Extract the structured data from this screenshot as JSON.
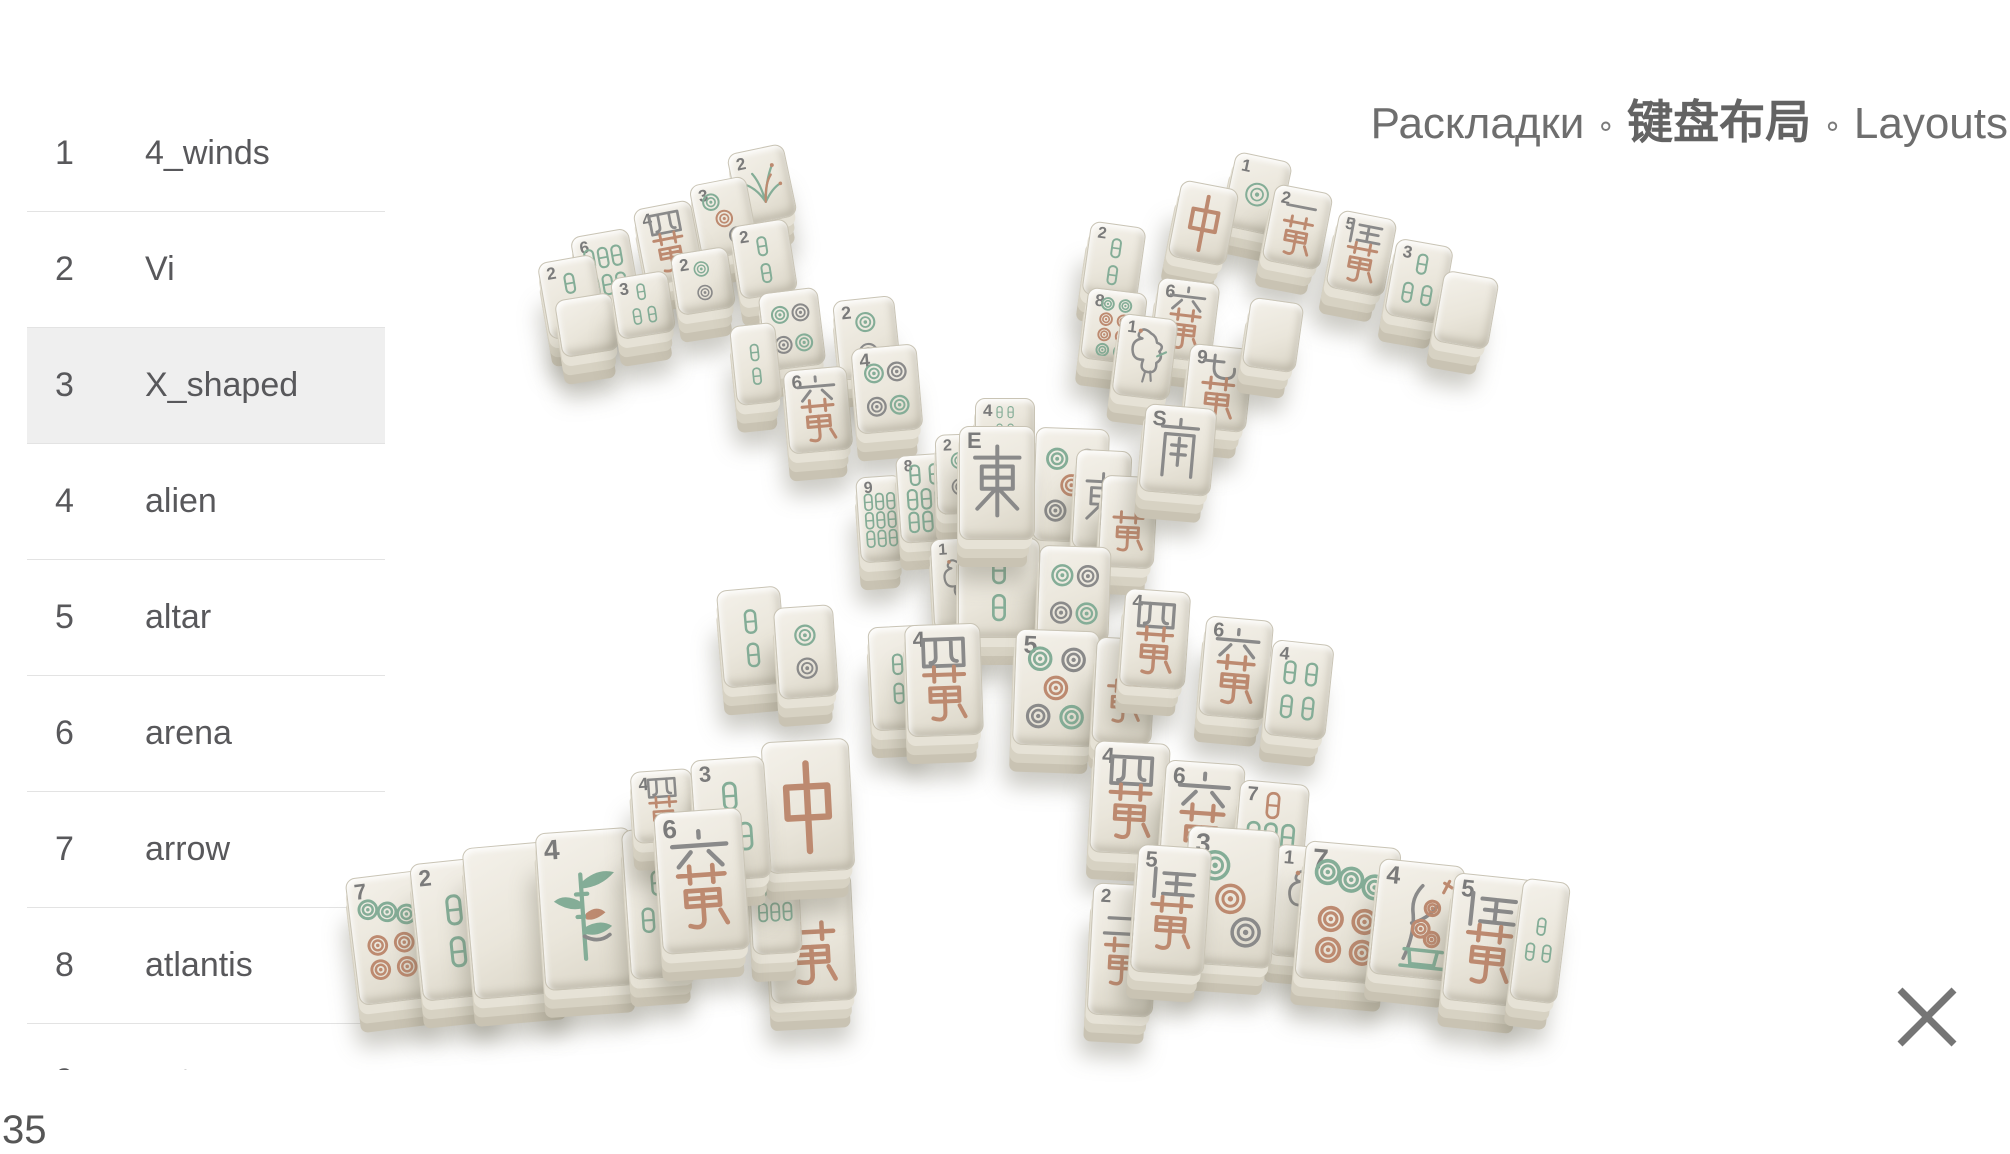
{
  "header": {
    "title_ru": "Раскладки",
    "title_zh": "键盘布局",
    "title_en": "Layouts",
    "separator": "∘"
  },
  "sidebar": {
    "selected_index": 2,
    "items": [
      {
        "num": "1",
        "label": "4_winds"
      },
      {
        "num": "2",
        "label": "Vi"
      },
      {
        "num": "3",
        "label": "X_shaped"
      },
      {
        "num": "4",
        "label": "alien"
      },
      {
        "num": "5",
        "label": "altar"
      },
      {
        "num": "6",
        "label": "arena"
      },
      {
        "num": "7",
        "label": "arrow"
      },
      {
        "num": "8",
        "label": "atlantis"
      },
      {
        "num": "9",
        "label": "aztec"
      }
    ]
  },
  "status": {
    "layouts_count": "35"
  },
  "icons": {
    "close": "✕"
  },
  "board": {
    "palette": {
      "face": "#ece8de",
      "green": "#84ad97",
      "red": "#bd8a70",
      "gray": "#8a8a8a",
      "num": "#7b7b7b"
    },
    "tiles": [
      {
        "x": 733,
        "y": 148,
        "w": 56,
        "h": 72,
        "r": -12,
        "kind": "flower",
        "num": "2"
      },
      {
        "x": 695,
        "y": 180,
        "w": 56,
        "h": 74,
        "r": -11,
        "kind": "circle",
        "n": 3,
        "num": "3"
      },
      {
        "x": 639,
        "y": 204,
        "w": 57,
        "h": 76,
        "r": -11,
        "kind": "wan",
        "n": 4,
        "num": "4"
      },
      {
        "x": 576,
        "y": 232,
        "w": 57,
        "h": 77,
        "r": -10,
        "kind": "bamboo",
        "n": 6,
        "num": "6"
      },
      {
        "x": 543,
        "y": 258,
        "w": 56,
        "h": 76,
        "r": -10,
        "kind": "bamboo",
        "n": 2,
        "num": "2"
      },
      {
        "x": 558,
        "y": 296,
        "w": 56,
        "h": 56,
        "r": -9,
        "kind": "blank",
        "num": ""
      },
      {
        "x": 614,
        "y": 274,
        "w": 56,
        "h": 60,
        "r": -9,
        "kind": "bamboo",
        "n": 3,
        "num": "3"
      },
      {
        "x": 674,
        "y": 250,
        "w": 56,
        "h": 60,
        "r": -9,
        "kind": "circle",
        "n": 2,
        "num": "2"
      },
      {
        "x": 735,
        "y": 222,
        "w": 56,
        "h": 72,
        "r": -9,
        "kind": "bamboo",
        "n": 2,
        "num": "2"
      },
      {
        "x": 762,
        "y": 290,
        "w": 58,
        "h": 76,
        "r": -7,
        "kind": "circle",
        "n": 4,
        "num": ""
      },
      {
        "x": 733,
        "y": 324,
        "w": 44,
        "h": 78,
        "r": -6,
        "kind": "bamboo",
        "n": 2,
        "num": ""
      },
      {
        "x": 836,
        "y": 298,
        "w": 60,
        "h": 78,
        "r": -6,
        "kind": "circle",
        "n": 2,
        "num": "2"
      },
      {
        "x": 786,
        "y": 368,
        "w": 62,
        "h": 82,
        "r": -5,
        "kind": "wan",
        "n": 6,
        "num": "6"
      },
      {
        "x": 854,
        "y": 346,
        "w": 64,
        "h": 84,
        "r": -5,
        "kind": "circle",
        "n": 4,
        "num": "4"
      },
      {
        "x": 858,
        "y": 476,
        "w": 44,
        "h": 84,
        "r": -4,
        "kind": "bamboo",
        "n": 9,
        "num": "9"
      },
      {
        "x": 898,
        "y": 454,
        "w": 54,
        "h": 86,
        "r": -4,
        "kind": "bamboo",
        "n": 8,
        "num": "8"
      },
      {
        "x": 1228,
        "y": 156,
        "w": 56,
        "h": 74,
        "r": 12,
        "kind": "circle",
        "n": 1,
        "num": "1"
      },
      {
        "x": 1174,
        "y": 184,
        "w": 57,
        "h": 76,
        "r": 11,
        "kind": "zhong",
        "num": ""
      },
      {
        "x": 1268,
        "y": 188,
        "w": 57,
        "h": 76,
        "r": 11,
        "kind": "wan",
        "n": 1,
        "num": "2"
      },
      {
        "x": 1332,
        "y": 214,
        "w": 57,
        "h": 77,
        "r": 11,
        "kind": "wan",
        "n": 5,
        "num": "5"
      },
      {
        "x": 1390,
        "y": 242,
        "w": 56,
        "h": 76,
        "r": 10,
        "kind": "bamboo",
        "n": 3,
        "num": "3"
      },
      {
        "x": 1438,
        "y": 274,
        "w": 54,
        "h": 70,
        "r": 10,
        "kind": "blank",
        "num": ""
      },
      {
        "x": 1086,
        "y": 224,
        "w": 54,
        "h": 72,
        "r": 8,
        "kind": "bamboo",
        "n": 2,
        "num": "2"
      },
      {
        "x": 1084,
        "y": 290,
        "w": 58,
        "h": 70,
        "r": 7,
        "kind": "circle",
        "n": 8,
        "num": "8"
      },
      {
        "x": 1154,
        "y": 280,
        "w": 60,
        "h": 78,
        "r": 7,
        "kind": "wan",
        "n": 6,
        "num": "6"
      },
      {
        "x": 1116,
        "y": 316,
        "w": 56,
        "h": 80,
        "r": 7,
        "kind": "bird",
        "num": "1"
      },
      {
        "x": 1186,
        "y": 346,
        "w": 62,
        "h": 82,
        "r": 6,
        "kind": "wan",
        "n": 9,
        "num": "9"
      },
      {
        "x": 1246,
        "y": 300,
        "w": 52,
        "h": 68,
        "r": 8,
        "kind": "blank",
        "num": ""
      },
      {
        "x": 975,
        "y": 398,
        "w": 58,
        "h": 44,
        "r": 0,
        "kind": "bamboo",
        "n": 4,
        "num": "4"
      },
      {
        "x": 936,
        "y": 434,
        "w": 46,
        "h": 78,
        "r": -2,
        "kind": "circle",
        "n": 2,
        "num": "2"
      },
      {
        "x": 1034,
        "y": 428,
        "w": 72,
        "h": 112,
        "r": 2,
        "kind": "circle",
        "n": 5,
        "num": ""
      },
      {
        "x": 1074,
        "y": 450,
        "w": 54,
        "h": 98,
        "r": 3,
        "kind": "east",
        "num": ""
      },
      {
        "x": 1100,
        "y": 476,
        "w": 54,
        "h": 90,
        "r": 3,
        "kind": "wan",
        "n": 0,
        "num": ""
      },
      {
        "x": 1142,
        "y": 406,
        "w": 70,
        "h": 86,
        "r": 5,
        "kind": "south",
        "num": "S"
      },
      {
        "x": 932,
        "y": 538,
        "w": 48,
        "h": 90,
        "r": -3,
        "kind": "bird",
        "num": "1"
      },
      {
        "x": 958,
        "y": 538,
        "w": 80,
        "h": 98,
        "r": 0,
        "kind": "bamboo",
        "n": 2,
        "num": ""
      },
      {
        "x": 1038,
        "y": 546,
        "w": 70,
        "h": 94,
        "r": 2,
        "kind": "circle",
        "n": 4,
        "num": ""
      },
      {
        "x": 959,
        "y": 426,
        "w": 74,
        "h": 112,
        "r": 0,
        "kind": "east",
        "num": "E"
      },
      {
        "x": 720,
        "y": 588,
        "w": 62,
        "h": 96,
        "r": -5,
        "kind": "bamboo",
        "n": 2,
        "num": ""
      },
      {
        "x": 776,
        "y": 606,
        "w": 58,
        "h": 90,
        "r": -4,
        "kind": "circle",
        "n": 2,
        "num": ""
      },
      {
        "x": 870,
        "y": 626,
        "w": 54,
        "h": 102,
        "r": -3,
        "kind": "bamboo",
        "n": 2,
        "num": ""
      },
      {
        "x": 906,
        "y": 624,
        "w": 74,
        "h": 110,
        "r": -2,
        "kind": "wan",
        "n": 4,
        "num": "4"
      },
      {
        "x": 1014,
        "y": 630,
        "w": 82,
        "h": 114,
        "r": 2,
        "kind": "circle",
        "n": 5,
        "num": "5"
      },
      {
        "x": 1094,
        "y": 638,
        "w": 58,
        "h": 104,
        "r": 3,
        "kind": "wan",
        "n": 0,
        "num": ""
      },
      {
        "x": 1122,
        "y": 590,
        "w": 64,
        "h": 96,
        "r": 4,
        "kind": "wan",
        "n": 4,
        "num": "4"
      },
      {
        "x": 1202,
        "y": 618,
        "w": 66,
        "h": 98,
        "r": 5,
        "kind": "wan",
        "n": 6,
        "num": "6"
      },
      {
        "x": 1268,
        "y": 642,
        "w": 60,
        "h": 94,
        "r": 6,
        "kind": "bamboo",
        "n": 4,
        "num": "4"
      },
      {
        "x": 352,
        "y": 874,
        "w": 74,
        "h": 126,
        "r": -7,
        "kind": "circle",
        "n": 7,
        "num": "7"
      },
      {
        "x": 416,
        "y": 860,
        "w": 78,
        "h": 136,
        "r": -6,
        "kind": "bamboo",
        "n": 2,
        "num": "2"
      },
      {
        "x": 468,
        "y": 844,
        "w": 96,
        "h": 150,
        "r": -5,
        "kind": "blank",
        "num": ""
      },
      {
        "x": 540,
        "y": 830,
        "w": 94,
        "h": 156,
        "r": -4,
        "kind": "plant",
        "num": "4"
      },
      {
        "x": 626,
        "y": 828,
        "w": 64,
        "h": 148,
        "r": -4,
        "kind": "bamboo",
        "n": 3,
        "num": ""
      },
      {
        "x": 632,
        "y": 770,
        "w": 60,
        "h": 70,
        "r": -4,
        "kind": "wan",
        "n": 4,
        "num": "4"
      },
      {
        "x": 768,
        "y": 874,
        "w": 84,
        "h": 126,
        "r": -3,
        "kind": "wan",
        "n": 0,
        "num": ""
      },
      {
        "x": 750,
        "y": 844,
        "w": 48,
        "h": 108,
        "r": -3,
        "kind": "bamboo",
        "n": 6,
        "num": ""
      },
      {
        "x": 764,
        "y": 740,
        "w": 86,
        "h": 130,
        "r": -3,
        "kind": "zhong",
        "num": ""
      },
      {
        "x": 694,
        "y": 758,
        "w": 72,
        "h": 120,
        "r": -4,
        "kind": "bamboo",
        "n": 3,
        "num": "3"
      },
      {
        "x": 658,
        "y": 810,
        "w": 86,
        "h": 140,
        "r": -4,
        "kind": "wan",
        "n": 6,
        "num": "6"
      },
      {
        "x": 1092,
        "y": 742,
        "w": 74,
        "h": 110,
        "r": 3,
        "kind": "wan",
        "n": 4,
        "num": "4"
      },
      {
        "x": 1162,
        "y": 762,
        "w": 78,
        "h": 112,
        "r": 4,
        "kind": "wan",
        "n": 6,
        "num": "6"
      },
      {
        "x": 1236,
        "y": 782,
        "w": 68,
        "h": 100,
        "r": 5,
        "kind": "bamboo",
        "n": 7,
        "num": "7"
      },
      {
        "x": 1090,
        "y": 884,
        "w": 64,
        "h": 130,
        "r": 3,
        "kind": "wan",
        "n": 2,
        "num": "2"
      },
      {
        "x": 1272,
        "y": 846,
        "w": 62,
        "h": 110,
        "r": 5,
        "kind": "bird",
        "num": "1"
      },
      {
        "x": 1184,
        "y": 828,
        "w": 90,
        "h": 136,
        "r": 4,
        "kind": "circle",
        "n": 3,
        "num": "3"
      },
      {
        "x": 1134,
        "y": 846,
        "w": 72,
        "h": 126,
        "r": 4,
        "kind": "wan",
        "n": 5,
        "num": "5"
      },
      {
        "x": 1300,
        "y": 844,
        "w": 94,
        "h": 136,
        "r": 5,
        "kind": "circle",
        "n": 7,
        "num": "7"
      },
      {
        "x": 1374,
        "y": 862,
        "w": 84,
        "h": 114,
        "r": 6,
        "kind": "plum",
        "num": "4"
      },
      {
        "x": 1448,
        "y": 876,
        "w": 80,
        "h": 126,
        "r": 6,
        "kind": "wan",
        "n": 5,
        "num": "5"
      },
      {
        "x": 1516,
        "y": 880,
        "w": 46,
        "h": 120,
        "r": 7,
        "kind": "bamboo",
        "n": 3,
        "num": ""
      }
    ]
  }
}
